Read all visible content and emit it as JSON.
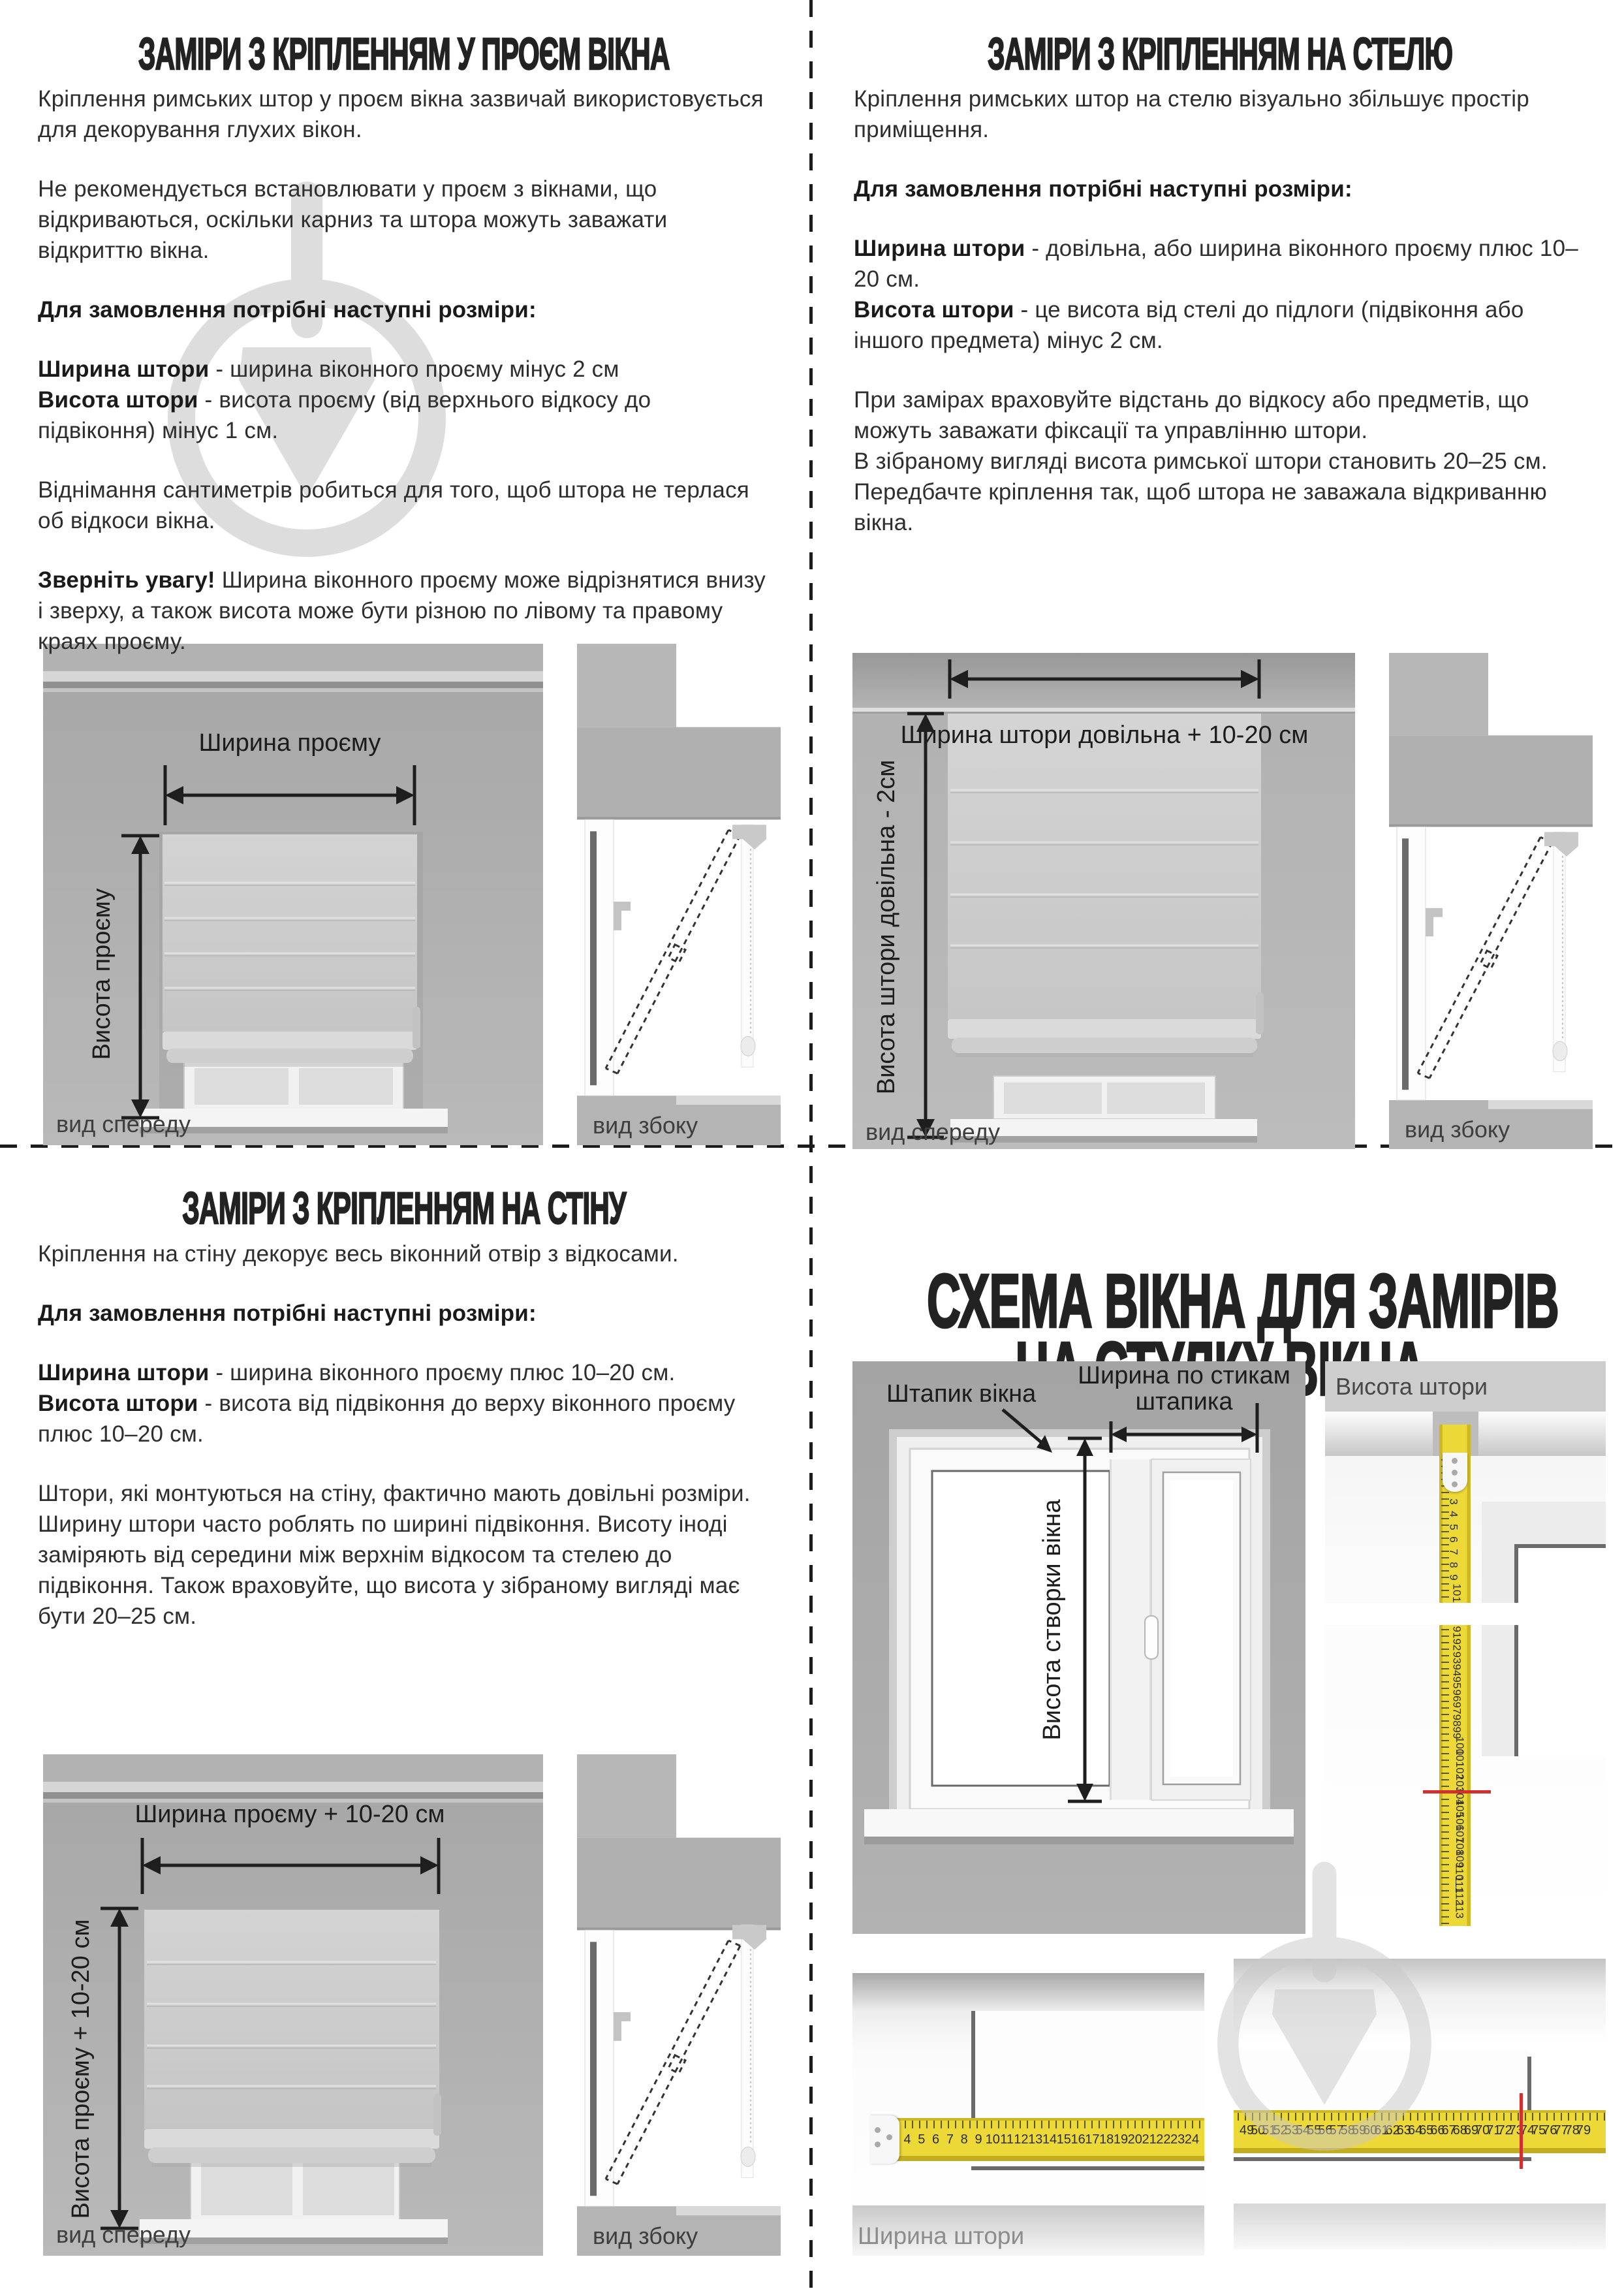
{
  "quadrants": {
    "tl": {
      "title": "ЗАМІРИ З КРІПЛЕННЯМ У ПРОЄМ ВІКНА",
      "p1": "Кріплення римських штор у проєм вікна зазвичай використовується для декорування глухих вікон.",
      "p2": "Не рекомендується встановлювати у проєм з вікнами, що відкриваються, оскільки карниз та штора можуть заважати відкриттю вікна.",
      "order_heading": "Для замовлення потрібні наступні розміри:",
      "width_term": "Ширина штори",
      "width_def": " - ширина віконного проєму мінус 2 см",
      "height_term": "Висота штори",
      "height_def": " - висота проєму (від верхнього відкосу до підвіконня) мінус 1 см.",
      "p5": "Віднімання сантиметрів робиться для того, щоб штора не терлася об відкоси вікна.",
      "note_term": "Зверніть увагу!",
      "note_def": " Ширина віконного проєму може відрізнятися внизу і зверху, а також висота може бути різною по лівому та правому краях проєму.",
      "arrow_w": "Ширина проєму",
      "arrow_h": "Висота проєму",
      "front_caption": "вид спереду",
      "side_caption": "вид збоку"
    },
    "tr": {
      "title": "ЗАМІРИ З КРІПЛЕННЯМ НА СТЕЛЮ",
      "p1": "Кріплення римських штор на стелю візуально збільшує простір приміщення.",
      "order_heading": "Для замовлення потрібні наступні розміри:",
      "width_term": "Ширина штори",
      "width_def": " - довільна, або ширина віконного проєму плюс 10–20 см.",
      "height_term": "Висота штори",
      "height_def": " - це висота від стелі до підлоги (підвіконня або іншого предмета) мінус 2 см.",
      "p4a": "При замірах враховуйте відстань до відкосу або предметів, що можуть заважати фіксації та управлінню штори.",
      "p4b": "В зібраному вигляді висота римської штори становить 20–25 см. Передбачте кріплення так, щоб штора не заважала відкриванню вікна.",
      "arrow_w": "Ширина штори довільна + 10-20 см",
      "arrow_h": "Висота штори довільна - 2см",
      "front_caption": "вид спереду",
      "side_caption": "вид збоку"
    },
    "bl": {
      "title": "ЗАМІРИ З КРІПЛЕННЯМ НА СТІНУ",
      "p1": "Кріплення на стіну декорує весь віконний отвір з відкосами.",
      "order_heading": "Для замовлення потрібні наступні розміри:",
      "width_term": "Ширина штори",
      "width_def": " - ширина віконного проєму плюс 10–20 см.",
      "height_term": "Висота штори",
      "height_def": " - висота від підвіконня до верху віконного проєму плюс 10–20 см.",
      "p4": "Штори, які монтуються на стіну, фактично мають довільні розміри. Ширину штори часто роблять по ширині підвіконня. Висоту іноді заміряють від середини між верхнім відкосом та стелею до підвіконня. Також враховуйте, що висота у зібраному вигляді має бути 20–25 см.",
      "arrow_w": "Ширина проєму + 10-20 см",
      "arrow_h": "Висота проєму + 10-20 см",
      "front_caption": "вид спереду",
      "side_caption": "вид збоку"
    },
    "br": {
      "title_line1": "СХЕМА ВІКНА ДЛЯ ЗАМІРІВ",
      "title_line2": "НА СТУЛКУ ВІКНА",
      "label_bead": "Штапик вікна",
      "label_width_l1": "Ширина по стикам",
      "label_width_l2": "штапика",
      "label_sash_height": "Висота створки вікна",
      "label_curtain_height": "Висота штори",
      "label_curtain_width": "Ширина штори",
      "tape_v": {
        "top_from": 3,
        "top_to": 11,
        "bottom_from": 91,
        "bottom_to": 113,
        "red_mark_at": 104
      },
      "tape_h": {
        "left_from": 4,
        "left_to": 24,
        "right_from": 49,
        "right_to": 79,
        "red_mark_at": 73
      }
    }
  },
  "colors": {
    "tape_yellow": "#ecd836",
    "red_mark": "#d22f2f",
    "wall_gray": "#aeaeae",
    "watermark_gray": "#d9d9d9",
    "text_dark": "#2e2e2e"
  }
}
